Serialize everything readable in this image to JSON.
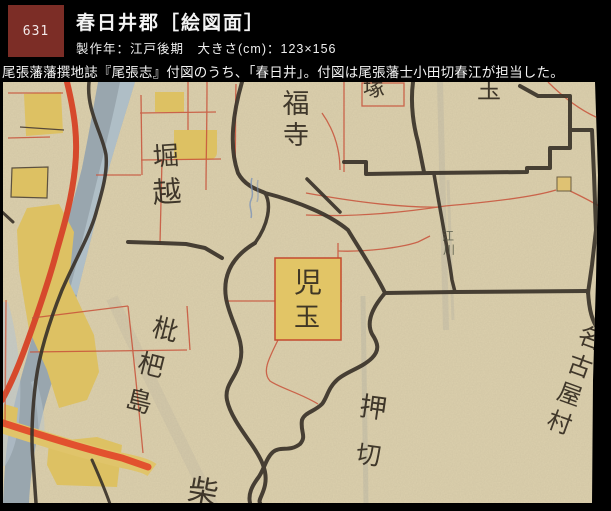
{
  "window": {
    "width": 611,
    "height": 511,
    "background": "#000000"
  },
  "header": {
    "catalog_number": "631",
    "number_box_color": "#7c2d26",
    "title": "春日井郡［絵図面］",
    "meta": "製作年：江戸後期　大きさ(cm)：123×156",
    "description": "尾張藩藩撰地誌『尾張志』付図のうち、「春日井」。付図は尾張藩士小田切春江が担当した。",
    "text_color": "#f4f4f4"
  },
  "map": {
    "type_note": "hand-drawn Edo-period district map scan",
    "paper_color": "#dcd0ad",
    "river_color": "#99a6ae",
    "river_light_color": "#b7c5ce",
    "road_color": "#d6492c",
    "field_color": "#ddc163",
    "boundary_color": "#3a332a",
    "parcel_line_color": "#c8523a",
    "labels": {
      "fukuji": {
        "text": "福寺",
        "chars": [
          "福",
          "寺"
        ]
      },
      "horikoshi": {
        "text": "堀越",
        "chars": [
          "堀",
          "越"
        ]
      },
      "kodama": {
        "text": "児玉",
        "chars": [
          "児",
          "玉"
        ]
      },
      "biwajima": {
        "text": "枇杷島",
        "chars": [
          "枇",
          "杷",
          "島"
        ]
      },
      "oshikiri": {
        "text": "押切",
        "chars": [
          "押",
          "切"
        ]
      },
      "nagoya_mura": {
        "text": "名古屋村",
        "chars": [
          "名",
          "古",
          "屋",
          "村"
        ]
      },
      "egawa": {
        "text": "江川",
        "chars": [
          "江",
          "川"
        ]
      },
      "partial_top_left": "塚",
      "partial_top_right": "玉",
      "partial_bottom": "柴"
    }
  }
}
